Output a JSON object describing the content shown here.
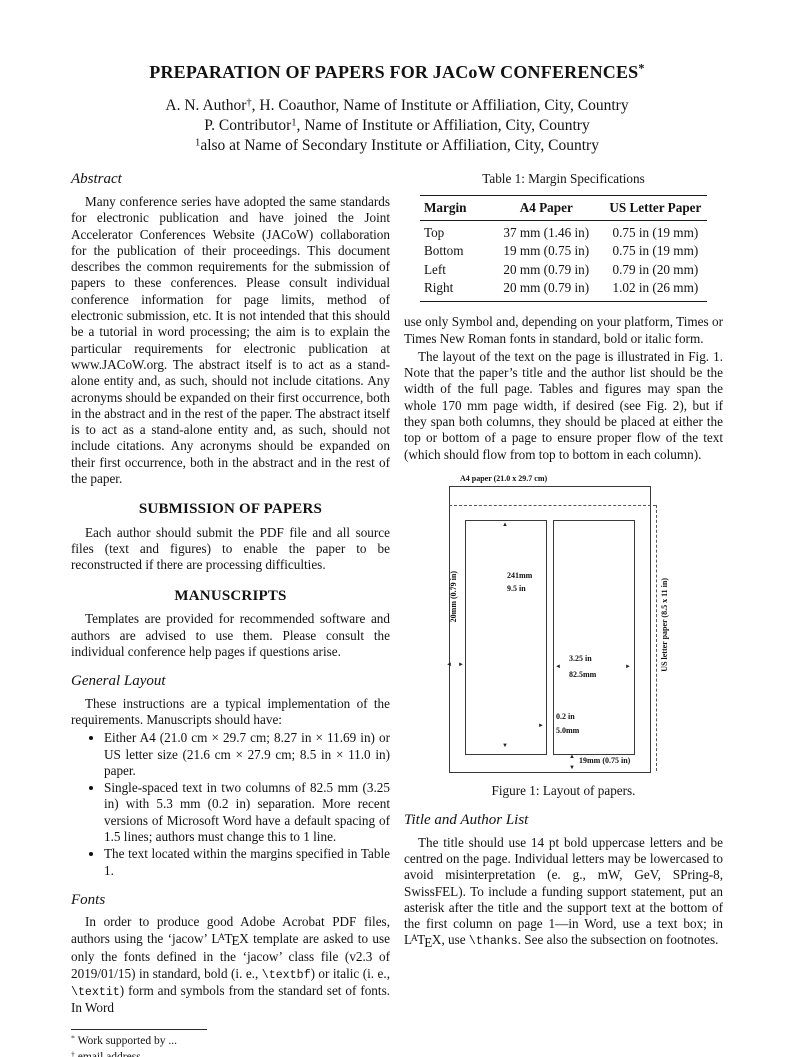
{
  "header": {
    "title": [
      {
        "t": "PREPARATION OF PAPERS FOR JACoW CONFERENCES"
      },
      {
        "t": "*",
        "s": "sup"
      }
    ],
    "author_lines": [
      [
        {
          "t": "A. N. Author"
        },
        {
          "t": "†",
          "s": "sup"
        },
        {
          "t": ", H. Coauthor, Name of Institute or Affiliation, City, Country"
        }
      ],
      [
        {
          "t": "P. Contributor"
        },
        {
          "t": "1",
          "s": "sup"
        },
        {
          "t": ", Name of Institute or Affiliation, City, Country"
        }
      ],
      [
        {
          "t": "1",
          "s": "sup"
        },
        {
          "t": "also at Name of Secondary Institute or Affiliation, City, Country"
        }
      ]
    ]
  },
  "left": {
    "abstract_heading": "Abstract",
    "abstract_text": "Many conference series have adopted the same standards for electronic publication and have joined the Joint Accelerator Conferences Website (JACoW) collaboration for the publication of their proceedings. This document describes the common requirements for the submission of papers to these conferences. Please consult individual conference information for page limits, method of electronic submission, etc. It is not intended that this should be a tutorial in word processing; the aim is to explain the particular requirements for electronic publication at www.JACoW.org. The abstract itself is to act as a stand-alone entity and, as such, should not include citations. Any acronyms should be expanded on their first occurrence, both in the abstract and in the rest of the paper. The abstract itself is to act as a stand-alone entity and, as such, should not include citations. Any acronyms should be expanded on their first occurrence, both in the abstract and in the rest of the paper.",
    "submission_heading": "SUBMISSION OF PAPERS",
    "submission_text": "Each author should submit the PDF file and all source files (text and figures) to enable the paper to be reconstructed if there are processing difficulties.",
    "manuscripts_heading": "MANUSCRIPTS",
    "manuscripts_text": "Templates are provided for recommended software and authors are advised to use them. Please consult the individual conference help pages if questions arise.",
    "general_layout_heading": "General Layout",
    "general_layout_intro": "These instructions are a typical implementation of the requirements. Manuscripts should have:",
    "general_layout_bullets": [
      "Either A4 (21.0 cm × 29.7 cm; 8.27 in × 11.69 in) or US letter size (21.6 cm × 27.9 cm; 8.5 in × 11.0 in) paper.",
      "Single-spaced text in two columns of 82.5 mm (3.25 in) with 5.3 mm (0.2 in) separation. More recent versions of Microsoft Word have a default spacing of 1.5 lines; authors must change this to 1 line.",
      "The text located within the margins specified in Table 1."
    ],
    "fonts_heading": "Fonts",
    "fonts_text": [
      {
        "t": "In order to produce good Adobe Acrobat PDF files, authors using the ‘jacow’ "
      },
      {
        "t": "LaTeX",
        "s": "latex"
      },
      {
        "t": " template are asked to use only the fonts defined in the ‘jacow’ class file (v2.3 of 2019/01/15) in standard, bold (i. e., "
      },
      {
        "t": "\\textbf",
        "s": "mono"
      },
      {
        "t": ") or italic (i. e., "
      },
      {
        "t": "\\textit",
        "s": "mono"
      },
      {
        "t": ") form and symbols from the standard set of fonts. In Word"
      }
    ],
    "footnotes": [
      [
        {
          "t": "*",
          "s": "sup"
        },
        {
          "t": " Work supported by ..."
        }
      ],
      [
        {
          "t": "†",
          "s": "sup"
        },
        {
          "t": " email address"
        }
      ]
    ]
  },
  "right": {
    "table1": {
      "caption": "Table 1: Margin Specifications",
      "headers": [
        "Margin",
        "A4 Paper",
        "US Letter Paper"
      ],
      "rows": [
        [
          "Top",
          "37 mm (1.46 in)",
          "0.75 in (19 mm)"
        ],
        [
          "Bottom",
          "19 mm (0.75 in)",
          "0.75 in (19 mm)"
        ],
        [
          "Left",
          "20 mm (0.79 in)",
          "0.79 in (20 mm)"
        ],
        [
          "Right",
          "20 mm (0.79 in)",
          "1.02 in (26 mm)"
        ]
      ]
    },
    "para_symbol": "use only Symbol and, depending on your platform, Times or Times New Roman fonts in standard, bold or italic form.",
    "para_layout": "The layout of the text on the page is illustrated in Fig. 1. Note that the paper’s title and the author list should be the width of the full page. Tables and figures may span the whole 170 mm page width, if desired (see Fig. 2), but if they span both columns, they should be placed at either the top or bottom of a page to ensure proper flow of the text (which should flow from top to bottom in each column).",
    "figure1": {
      "caption": "Figure 1: Layout of papers.",
      "labels": {
        "a4_paper": "A4 paper (21.0 x 29.7 cm)",
        "col_height_mm": "241mm",
        "col_height_in": "9.5 in",
        "left_margin": "20mm (0.79 in)",
        "col_width_in": "3.25 in",
        "col_width_mm": "82.5mm",
        "gap_in": "0.2 in",
        "gap_mm": "5.0mm",
        "bottom_margin": "19mm (0.75 in)",
        "us_letter": "US letter paper (8.5 x 11 in)"
      }
    },
    "title_author_heading": "Title and Author List",
    "title_author_text": [
      {
        "t": "The title should use 14 pt bold uppercase letters and be centred on the page. Individual letters may be lowercased to avoid misinterpretation (e. g., mW, GeV, SPring-8, SwissFEL). To include a funding support statement, put an asterisk after the title and the support text at the bottom of the first column on page 1—in Word, use a text box; in "
      },
      {
        "t": "LaTeX",
        "s": "latex"
      },
      {
        "t": ", use "
      },
      {
        "t": "\\thanks",
        "s": "mono"
      },
      {
        "t": ". See also the subsection on footnotes."
      }
    ]
  }
}
